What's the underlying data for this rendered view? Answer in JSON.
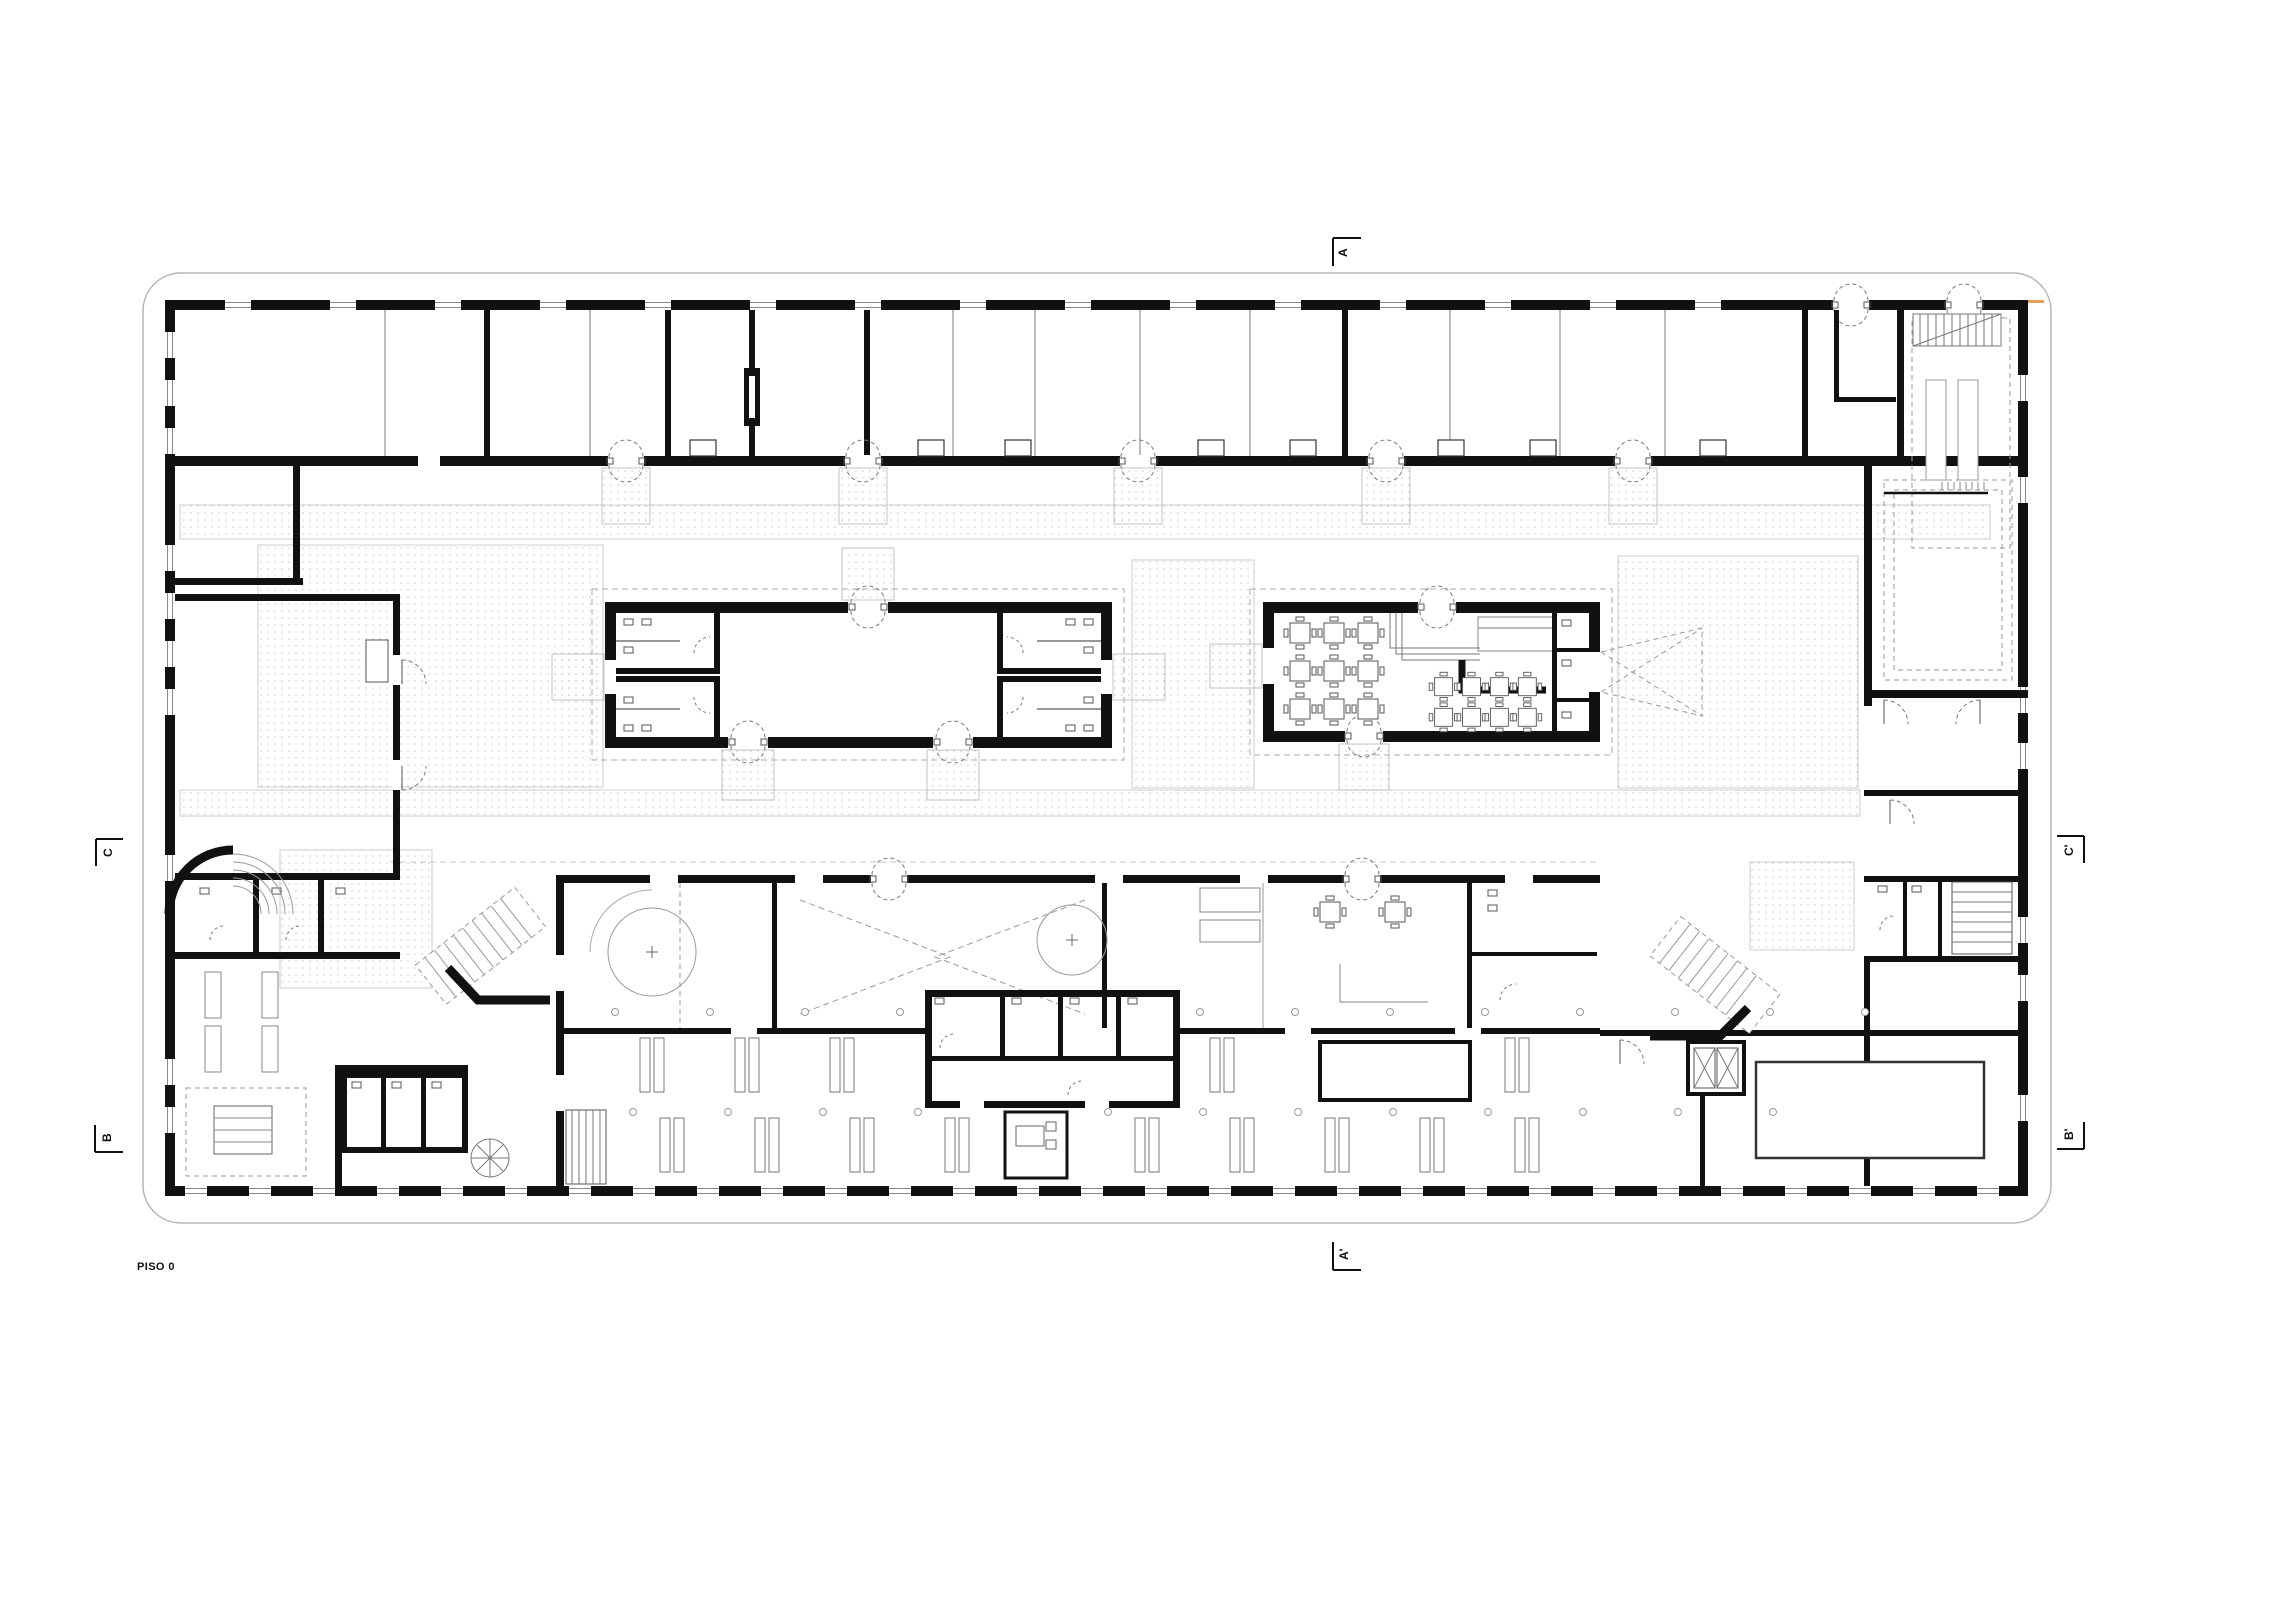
{
  "title": {
    "label": "PISO 0"
  },
  "drawing": {
    "name": "architectural-floor-plan-piso-0"
  },
  "section_markers": {
    "a_top": "A",
    "a_bottom": "A'",
    "c_left": "C",
    "c_right": "C'",
    "b_left": "B",
    "b_right": "B'"
  },
  "colors": {
    "ink": "#111111",
    "thin_line": "#8a8a8a",
    "light_line": "#bcbcbc",
    "stipple": "#c9c9c9",
    "accent_tick": "#e2a25a",
    "paper": "#ffffff"
  },
  "icons": [
    "butterfly-door-icon",
    "door-swing-icon",
    "spiral-stair-icon",
    "elevator-x-icon",
    "table-with-chairs-icon",
    "column-icon",
    "stair-treads-icon"
  ]
}
